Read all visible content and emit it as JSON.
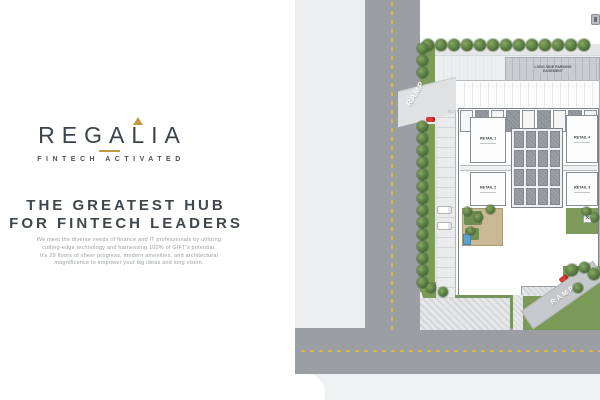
{
  "brand": {
    "name": "REGALIA",
    "tagline": "FINTECH ACTIVATED",
    "accent_color": "#c49a3f",
    "text_color": "#3d434a"
  },
  "hero": {
    "headline_line1": "THE GREATEST HUB",
    "headline_line2": "FOR FINTECH LEADERS",
    "paragraph_lines": [
      "We meet the diverse needs of finance and IT professionals by utilizing",
      "cutting-edge technology and harnessing 100% of GIFT's potential.",
      "It's 29 floors of sheer progress, modern amenities, and architectural",
      "magnificence to empower your big ideas and long vision."
    ]
  },
  "site_plan": {
    "labels": {
      "ramp": "RAMP",
      "slope": "SLOPE",
      "parking_line1": "LONG SIDE PARKING",
      "parking_line2": "EASEMENT",
      "entrance": "ENTRANCE",
      "x_marker": "×"
    },
    "retail_units": [
      "RETAIL 1",
      "RETAIL 2",
      "RETAIL 3",
      "RETAIL 4"
    ],
    "colors": {
      "road": "#9b9ea2",
      "lane_line": "#d8b84e",
      "greenery": "#7b9a58",
      "pavement": "#eceeef",
      "red_marker": "#d43c34"
    }
  }
}
